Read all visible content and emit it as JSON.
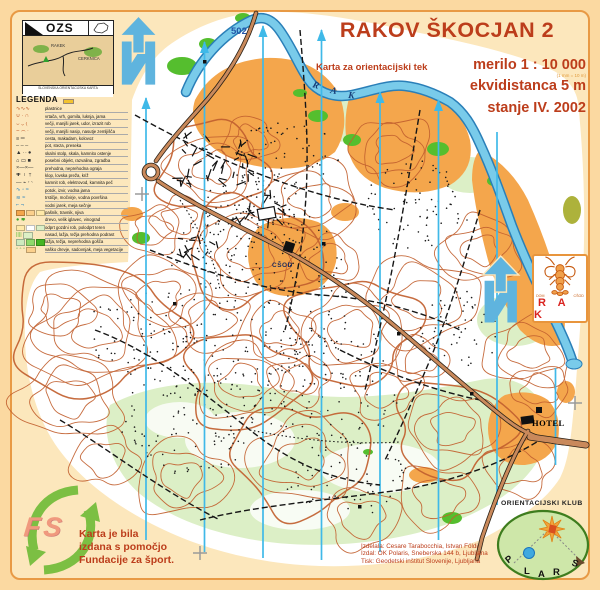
{
  "colors": {
    "sheet_outer": "#FBD9A1",
    "sheet_inner": "#FCE7BC",
    "frame_border": "#E89A45",
    "forest_white": "#FFFFFF",
    "open_orange": "#F4A64C",
    "pale_green": "#DCEFC6",
    "bright_green": "#55BE2E",
    "river_fill": "#79CBEA",
    "river_edge": "#2A7FB8",
    "contour_brown": "#C2602F",
    "north_line_cyan": "#3FB9E8",
    "road_fill": "#C9895B",
    "title_red": "#BC3D1B",
    "fs_green": "#7CBF43",
    "fs_salmon": "#F0997E"
  },
  "ozs": {
    "acronym": "OZS",
    "towns": [
      "RAKEK",
      "CERKNICA"
    ],
    "footer": "SLOVENSKA ORIENTACIJSKA KARTA"
  },
  "legend": {
    "title": "LEGENDA",
    "rows": [
      {
        "label": "plastnice",
        "chips": [
          {
            "t": "g",
            "v": "∿∿∿",
            "c": "#C2602F"
          }
        ]
      },
      {
        "label": "vrtača, vrh, gomila, luknja, jama",
        "chips": [
          {
            "t": "g",
            "v": "∪ · ∩",
            "c": "#C2602F"
          }
        ]
      },
      {
        "label": "večji, manjši jarek, udor, izrazit rob",
        "chips": [
          {
            "t": "g",
            "v": "⌣ ⌄ ⟨",
            "c": "#C2602F"
          }
        ]
      },
      {
        "label": "večji, manjši nasip, nasutje zemljišča",
        "chips": [
          {
            "t": "g",
            "v": "⌢ ⌒ ·",
            "c": "#C2602F"
          }
        ]
      },
      {
        "label": "cesta, makadam, kolovoz",
        "chips": [
          {
            "t": "g",
            "v": "≡ ═",
            "c": "#333333"
          }
        ]
      },
      {
        "label": "pot, steza, preseka",
        "chips": [
          {
            "t": "g",
            "v": "– – –",
            "c": "#333333"
          }
        ]
      },
      {
        "label": "skalni stolp, skala, kamnito ostenje",
        "chips": [
          {
            "t": "g",
            "v": "▲ ∴ ●",
            "c": "#333333"
          }
        ]
      },
      {
        "label": "posebni objekt, razvalina, zgradba",
        "chips": [
          {
            "t": "g",
            "v": "⌂ ▭ ■",
            "c": "#333333"
          }
        ]
      },
      {
        "label": "prehodna, neprehodna ograja",
        "chips": [
          {
            "t": "g",
            "v": "×—×—",
            "c": "#333333"
          }
        ]
      },
      {
        "label": "klop, lovska preža, križ",
        "chips": [
          {
            "t": "g",
            "v": "✚ ⊤ †",
            "c": "#333333"
          }
        ]
      },
      {
        "label": "kamnit rob, elektrovod, kamnita peč",
        "chips": [
          {
            "t": "g",
            "v": "— ⌁ ◠",
            "c": "#333333"
          }
        ]
      },
      {
        "label": "potok, izvir, vodna jama",
        "chips": [
          {
            "t": "g",
            "v": "∿ ◦ ≈",
            "c": "#2E86C1"
          }
        ]
      },
      {
        "label": "trstičje, močvirje, vodna površina",
        "chips": [
          {
            "t": "g",
            "v": "≋ ≈",
            "c": "#2E86C1"
          }
        ]
      },
      {
        "label": "vodni jarek, meja sečnje",
        "chips": [
          {
            "t": "g",
            "v": "⌐ ¬",
            "c": "#2E86C1"
          }
        ]
      },
      {
        "label": "pašnik, travnik, njiva",
        "chips": [
          {
            "t": "b",
            "c": "#F4A64C"
          },
          {
            "t": "b",
            "c": "#FBD08C"
          },
          {
            "t": "b",
            "c": "#FFE9A8"
          }
        ]
      },
      {
        "label": "drevo, velik iglavec, vinograd",
        "chips": [
          {
            "t": "g",
            "v": "● ✱",
            "c": "#3FA32A"
          }
        ]
      },
      {
        "label": "odprt gozdni rob, polodprt teren",
        "chips": [
          {
            "t": "b",
            "c": "#FFE9A8"
          },
          {
            "t": "b",
            "c": "#FFFFFF"
          },
          {
            "t": "b",
            "c": "#DCEFC6"
          }
        ]
      },
      {
        "label": "nasad, lažja, težja prehodna podrast",
        "chips": [
          {
            "t": "g",
            "v": "||||",
            "c": "#57BE33"
          },
          {
            "t": "b",
            "c": "#DCEFC6"
          }
        ]
      },
      {
        "label": "lažja, težja, neprehodna gošča",
        "chips": [
          {
            "t": "b",
            "c": "#CDEABF"
          },
          {
            "t": "b",
            "c": "#8FD96C"
          },
          {
            "t": "b",
            "c": "#45B524"
          }
        ]
      },
      {
        "label": "vaško drevje, sadovnjak, meja vegetacije",
        "chips": [
          {
            "t": "g",
            "v": "◦ ◦ ◦",
            "c": "#3FA32A"
          },
          {
            "t": "b",
            "c": "#FBD08C"
          }
        ]
      }
    ]
  },
  "title_block": {
    "title": "RAKOV ŠKOCJAN 2",
    "subtitle": "Karta za orientacijski tek",
    "scale": "merilo 1 : 10 000",
    "scale_note": "(1 mm = 10 m)",
    "equidistance": "ekvidistanca 5 m",
    "status": "stanje IV. 2002"
  },
  "map_labels": {
    "road_number": "502",
    "river_letters": [
      "R",
      "A",
      "K"
    ],
    "school": "CŠOD",
    "hotel": "HOTEL"
  },
  "fs": {
    "logo": "FS",
    "lines": [
      "Karta je bila",
      "izdana s pomočjo",
      "Fundacije za šport."
    ]
  },
  "polaris": {
    "club": "ORIENTACIJSKI KLUB",
    "letters": [
      "P",
      "L",
      "A",
      "R",
      "S"
    ],
    "credits": [
      "Izdelala: Cesare Tarabocchia, Istvan Földi",
      "Izdal: OK Polaris, Sneberska 144 b, Ljubljana",
      "Tisk: Geodetski inštitut Slovenije, Ljubljana"
    ]
  },
  "rak": {
    "left": "DOM",
    "right": "CŠOD",
    "name": "R A K"
  }
}
